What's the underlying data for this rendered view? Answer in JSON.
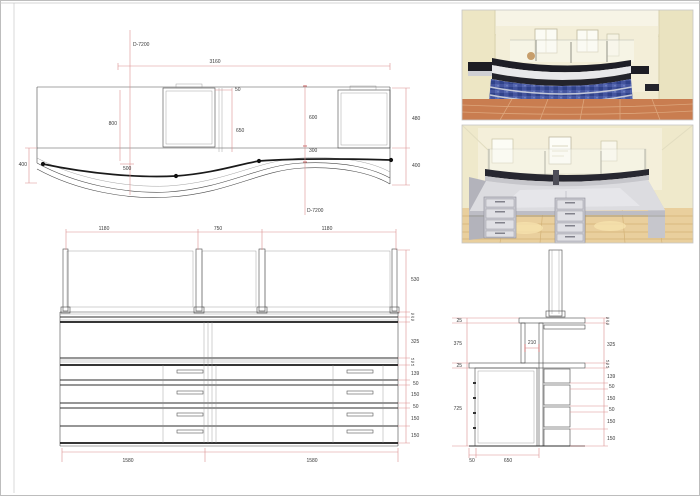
{
  "sheet": {
    "palette": {
      "dim_line": "#dd8f8f",
      "drawing_line": "#3a3a3a",
      "heavy_line": "#1a1a1a",
      "blue_panel": "#44549e",
      "counter_black": "#1e1e26",
      "wall_cream": "#f0ead0",
      "floor_terracotta": "#c97d50",
      "floor_tan": "#e9cf9d",
      "desk_grey": "#dcdce0"
    }
  },
  "plan_view": {
    "datum": "D-7200",
    "dims": {
      "total": "3160",
      "fifty": "50",
      "back": "800",
      "five_hundred": "500",
      "monitor": "650",
      "six_hundred": "600",
      "three_hundred": "300",
      "left": "400",
      "right_top": "480",
      "right_bottom": "400"
    }
  },
  "front_view": {
    "top_dims": [
      "1180",
      "750",
      "1180"
    ],
    "right_dims": [
      "530",
      "325",
      "139",
      "50",
      "150",
      "50",
      "150",
      "150"
    ],
    "cluster_top": [
      "50",
      "20",
      "50"
    ],
    "cluster_mid": [
      "18",
      "50",
      "18"
    ],
    "bottom_dims": [
      "1580",
      "1580"
    ]
  },
  "section_view": {
    "left_dims": [
      "25",
      "375",
      "25",
      "725"
    ],
    "center_dim": "210",
    "cluster_top": [
      "50",
      "20",
      "50"
    ],
    "cluster_mid": [
      "18",
      "50",
      "18"
    ],
    "right_dims": [
      "325",
      "139",
      "50",
      "150",
      "50",
      "150",
      "150"
    ],
    "bottom_dims": [
      "50",
      "650"
    ]
  }
}
